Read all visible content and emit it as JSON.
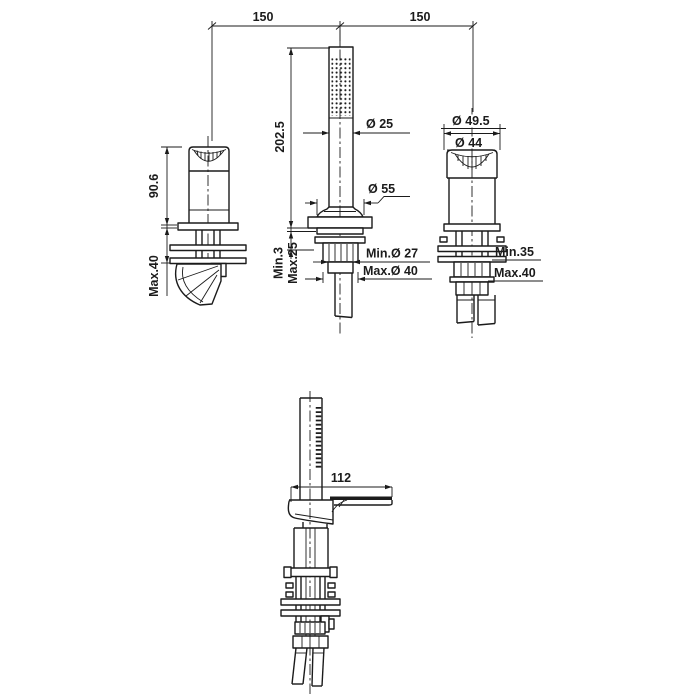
{
  "meta": {
    "drawing_type": "technical dimension drawing",
    "background_color": "#ffffff",
    "line_color": "#1b1b1b"
  },
  "labels": {
    "span_left": "150",
    "span_right": "150",
    "valve_height": "90.6",
    "valve_deck_max": "Max.40",
    "shower_height": "202.5",
    "deck_min_thickness": "Min.3",
    "deck_max_thickness": "Max.25",
    "handle_dia": "Ø 25",
    "rosette_dia": "Ø 55",
    "hole_dia_min": "Min.Ø 27",
    "hole_dia_max": "Max.Ø 40",
    "knob_dia_outer": "Ø 49.5",
    "knob_dia_inner": "Ø 44",
    "right_deck_min": "Min.35",
    "right_deck_max": "Max.40",
    "spout_reach": "112"
  }
}
